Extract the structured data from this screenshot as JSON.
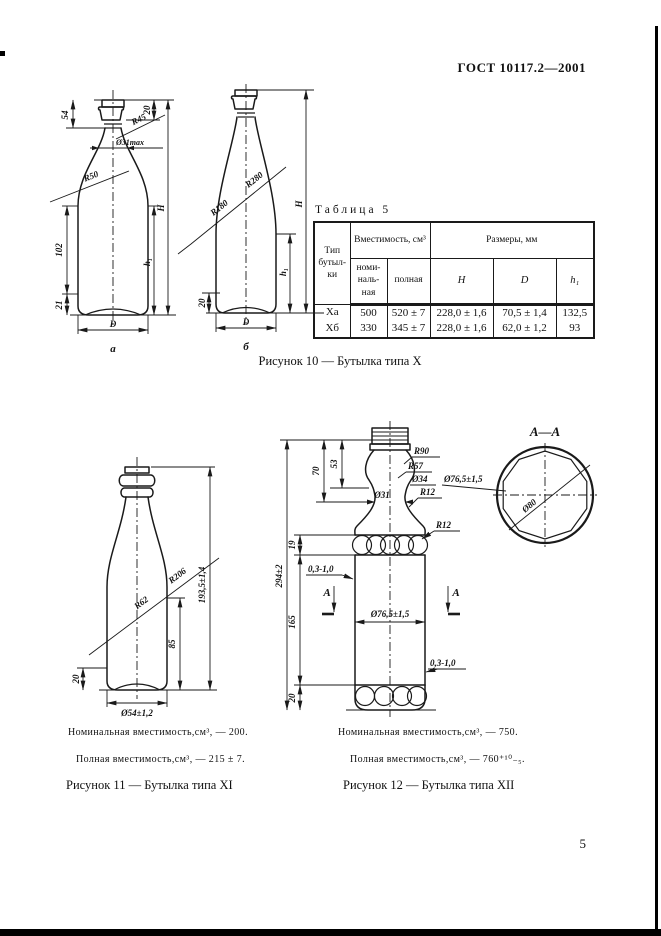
{
  "doc": {
    "header": "ГОСТ 10117.2—2001",
    "page_number": "5"
  },
  "fig10": {
    "caption": "Рисунок 10 — Бутылка типа X",
    "bottle_a": {
      "label": "а",
      "dim54": "54",
      "dim20": "20",
      "dim102": "102",
      "dim21": "21",
      "r45": "R45",
      "r50": "R50",
      "dia31": "Ø31max",
      "dimH": "H",
      "dimh1": "h₁",
      "dimD": "D"
    },
    "bottle_b": {
      "label": "б",
      "dim20": "20",
      "r180": "R180",
      "r280": "R280",
      "dimH": "H",
      "dimh1": "h₁",
      "dimD": "D"
    }
  },
  "table5": {
    "title": "Таблица 5",
    "head_type": "Тип бутыл-ки",
    "head_capacity": "Вместимость, см³",
    "head_nominal": "номи-наль-ная",
    "head_full": "полная",
    "head_sizes": "Размеры, мм",
    "head_H": "H",
    "head_D": "D",
    "head_h1": "h₁",
    "rows": [
      [
        "Ха",
        "500",
        "520 ± 7",
        "228,0 ± 1,6",
        "70,5 ± 1,4",
        "132,5"
      ],
      [
        "Хб",
        "330",
        "345 ± 7",
        "228,0 ± 1,6",
        "62,0 ± 1,2",
        "93"
      ]
    ]
  },
  "fig11": {
    "caption": "Рисунок 11 — Бутылка типа XI",
    "note_nominal": "Номинальная вместимость,см³, — 200.",
    "note_full": "Полная вместимость,см³, — 215 ± 7.",
    "r62": "R62",
    "r206": "R206",
    "dim_height": "193,5±1,4",
    "dim85": "85",
    "dim20": "20",
    "dia54": "Ø54±1,2"
  },
  "fig12": {
    "caption": "Рисунок 12 — Бутылка типа XII",
    "note_nominal": "Номинальная вместимость,см³, — 750.",
    "note_full": "Полная вместимость,см³, — 760⁺¹⁰₋₅.",
    "section": "А—А",
    "dia80": "Ø80",
    "r90": "R90",
    "r57": "R57",
    "dia34": "Ø34",
    "dia31": "Ø31",
    "r12a": "R12",
    "r12b": "R12",
    "dia765a": "Ø76,5±1,5",
    "dia765b": "Ø76,5±1,5",
    "dim70": "70",
    "dim53": "53",
    "dim294": "294±2",
    "dim19": "19",
    "dim165": "165",
    "dim20": "20",
    "wall_a": "0,3-1,0",
    "wall_b": "0,3-1,0",
    "markA": "A"
  }
}
